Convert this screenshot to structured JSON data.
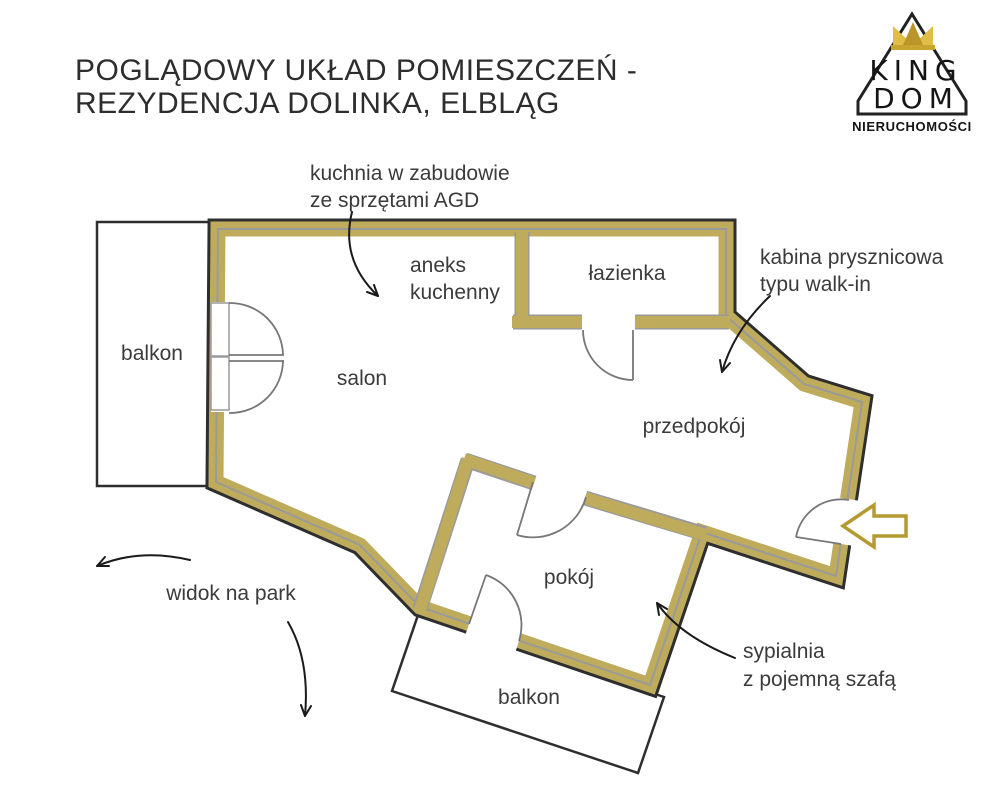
{
  "title": {
    "line1": "POGLĄDOWY UKŁAD POMIESZCZEŃ -",
    "line2": "REZYDENCJA DOLINKA, ELBLĄG"
  },
  "logo": {
    "word_top": "KING",
    "word_bottom": "DOM",
    "subtitle": "NIERUCHOMOŚCI",
    "icons": [
      "house-icon",
      "crown-icon"
    ]
  },
  "rooms": {
    "balcony_left": "balkon",
    "living": "salon",
    "kitchenette_line1": "aneks",
    "kitchenette_line2": "kuchenny",
    "bathroom": "łazienka",
    "hallway": "przedpokój",
    "bedroom": "pokój",
    "balcony_bottom": "balkon"
  },
  "annotations": {
    "kitchen_line1": "kuchnia w zabudowie",
    "kitchen_line2": "ze sprzętami AGD",
    "shower_line1": "kabina prysznicowa",
    "shower_line2": "typu walk-in",
    "park": "widok na park",
    "bedroom_line1": "sypialnia",
    "bedroom_line2": "z pojemną szafą"
  },
  "colors": {
    "wall_gold": "#beac5c",
    "wall_outline": "#2e2e2e",
    "wall_inner_gray": "#9a9a9a",
    "crown_gold_light": "#e0bd45",
    "crown_gold_dark": "#b9952a",
    "entrance_arrow_gold": "#b49a30",
    "text": "#3b3b3b"
  }
}
